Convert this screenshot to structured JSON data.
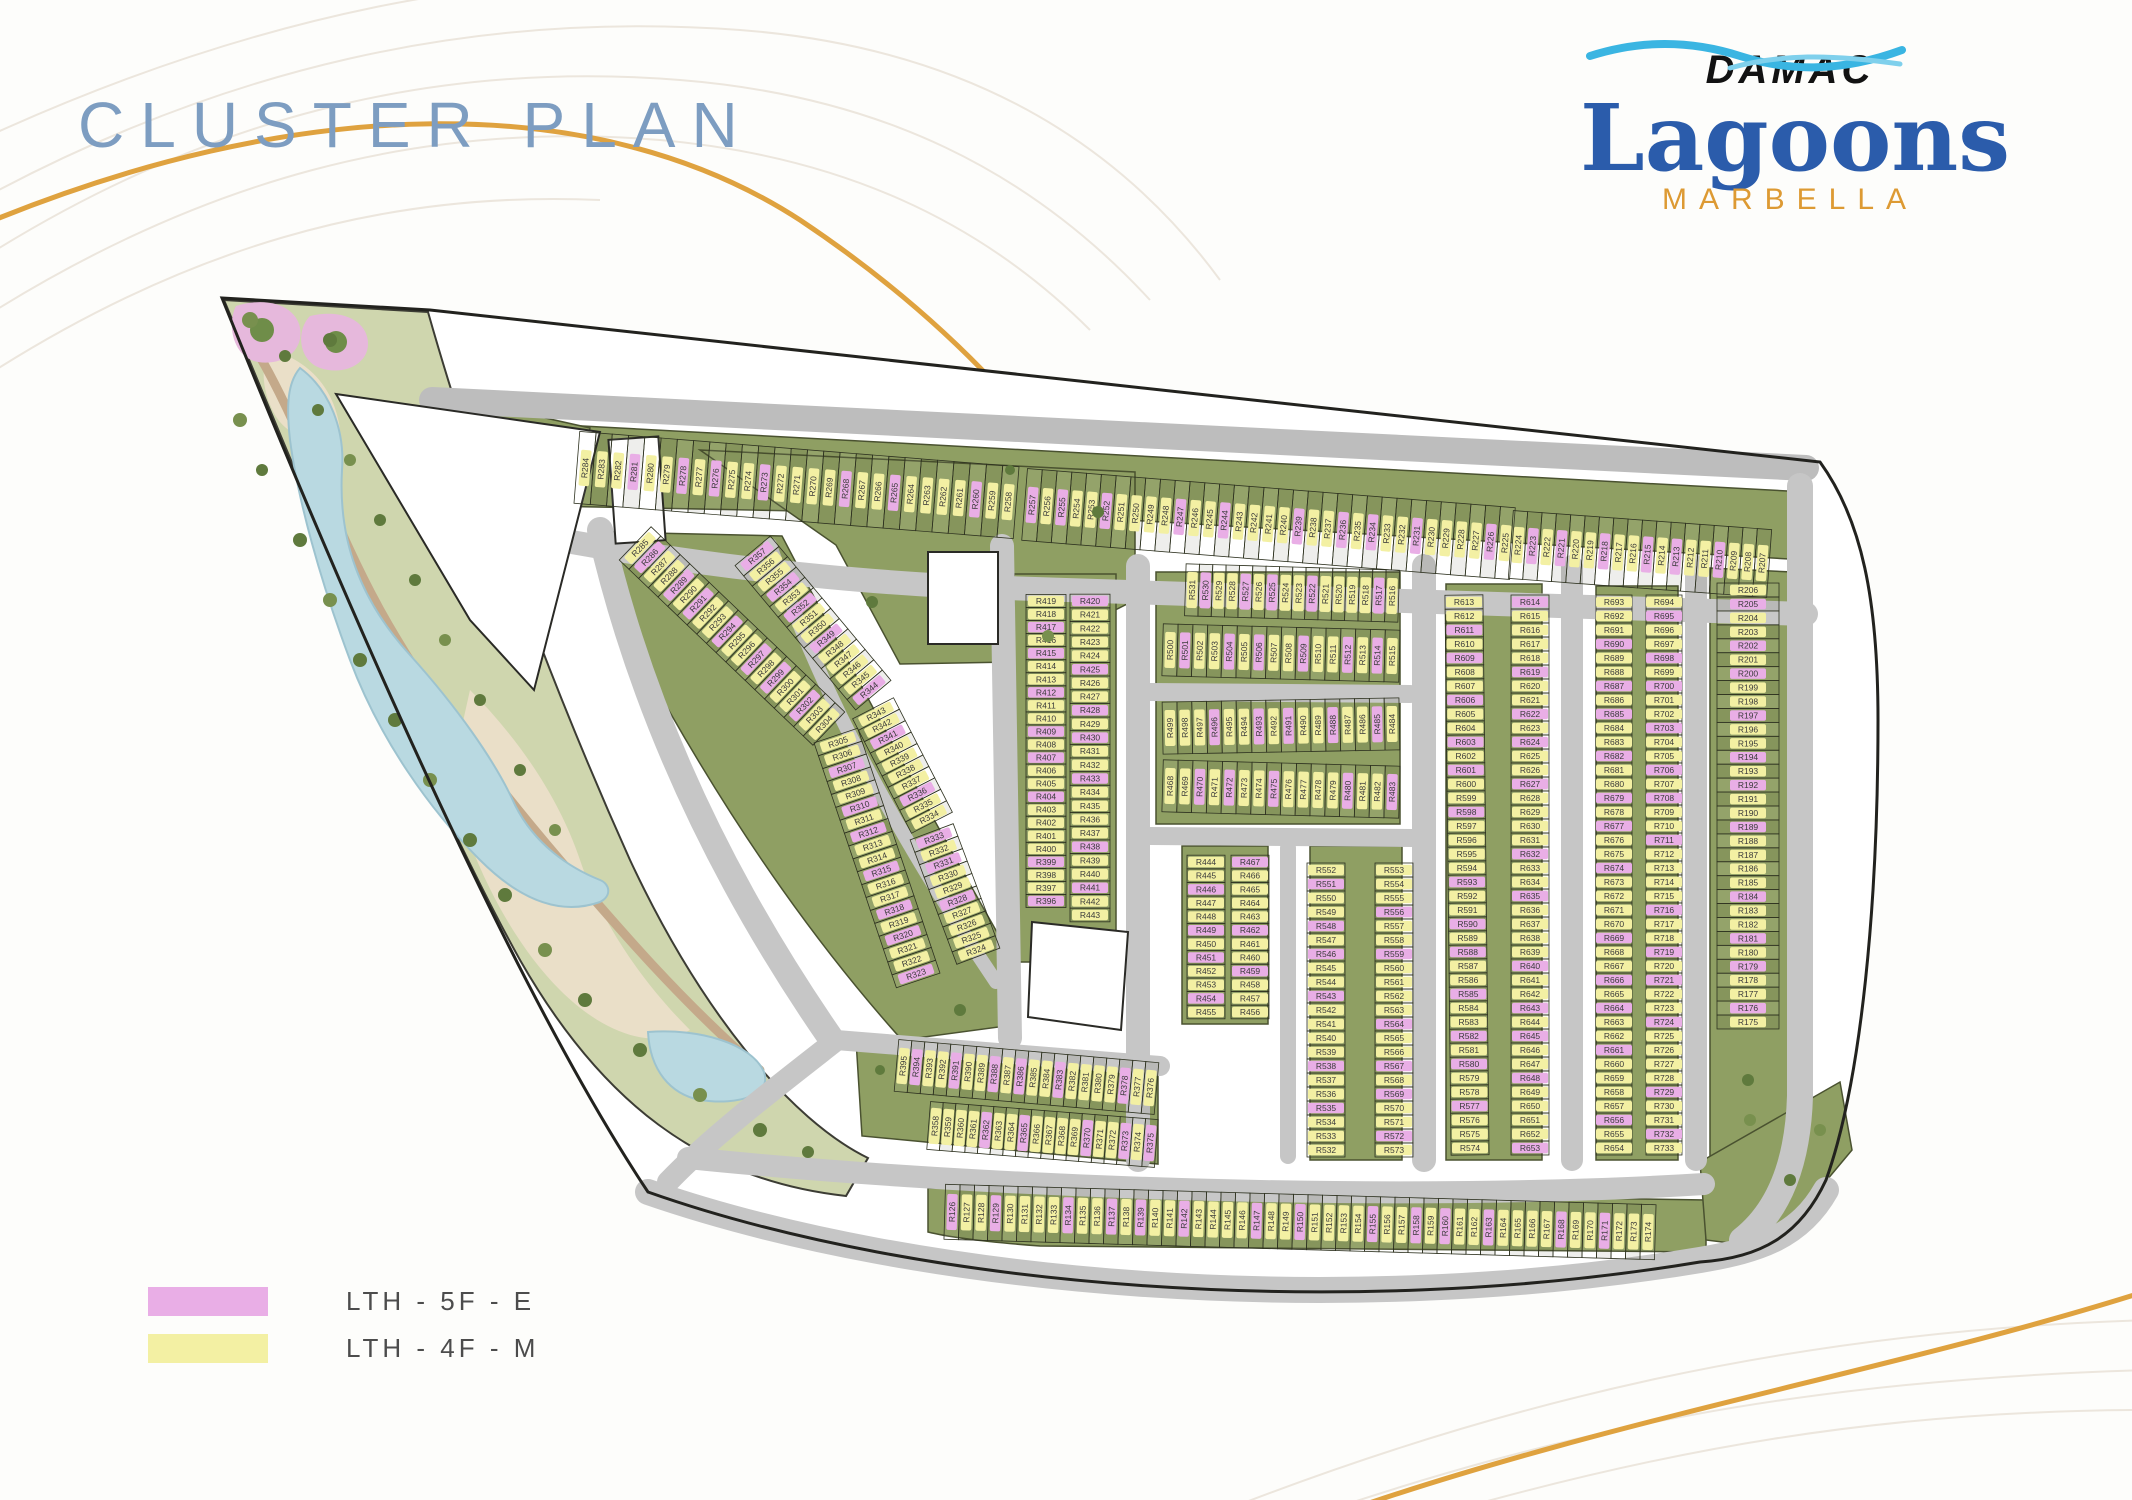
{
  "page": {
    "title": "CLUSTER PLAN"
  },
  "logo": {
    "brand": "DAMAC",
    "name": "Lagoons",
    "community": "MARBELLA"
  },
  "legend": {
    "items": [
      {
        "label": "LTH - 5F - E",
        "color": "#e9aee6"
      },
      {
        "label": "LTH - 4F - M",
        "color": "#f3f0a3"
      }
    ]
  },
  "colors": {
    "green": "#8f9f63",
    "greenEdge": "#4a5230",
    "road": "#c6c6c6",
    "roadDark": "#bdbdbd",
    "outline": "#22221e",
    "cellLine": "#2e3220",
    "pink": "#e9aee6",
    "yellow": "#f3f0a3",
    "labelText": "#3a3a3a",
    "water": "#b9d9e1",
    "sand": "#eadfc8",
    "path": "#c4a98a",
    "stripBase": "#cfd6ae",
    "flower": "#e6b8dc",
    "titleBlue": "#7d9dc1",
    "accentOrange": "#dfa23f"
  },
  "plan": {
    "unit_prefix": "R",
    "unit_number_min": 126,
    "unit_number_max": 733,
    "rows": [
      {
        "name": "top-row-west",
        "f": 284,
        "t": 258,
        "x1": 585,
        "y1": 468,
        "x2": 1008,
        "y2": 502,
        "d": 72,
        "flat": false
      },
      {
        "name": "top-row-center",
        "f": 257,
        "t": 225,
        "x1": 1032,
        "y1": 505,
        "x2": 1505,
        "y2": 543,
        "d": 72,
        "flat": false
      },
      {
        "name": "top-row-east",
        "f": 224,
        "t": 207,
        "x1": 1518,
        "y1": 545,
        "x2": 1762,
        "y2": 563,
        "d": 68,
        "flat": false
      },
      {
        "name": "right-edge-column",
        "f": 206,
        "t": 175,
        "x1": 1748,
        "y1": 590,
        "x2": 1748,
        "y2": 1022,
        "d": 62,
        "flat": true
      },
      {
        "name": "bottom-row",
        "f": 126,
        "t": 174,
        "x1": 952,
        "y1": 1212,
        "x2": 1648,
        "y2": 1232,
        "d": 55,
        "flat": false
      },
      {
        "name": "southwest-row-a",
        "f": 395,
        "t": 376,
        "x1": 903,
        "y1": 1066,
        "x2": 1150,
        "y2": 1088,
        "d": 52,
        "flat": false
      },
      {
        "name": "southwest-row-b",
        "f": 358,
        "t": 375,
        "x1": 935,
        "y1": 1126,
        "x2": 1150,
        "y2": 1143,
        "d": 48,
        "flat": false
      },
      {
        "name": "arc-outer-upper",
        "f": 285,
        "t": 304,
        "x1": 640,
        "y1": 548,
        "x2": 824,
        "y2": 724,
        "d": 46,
        "flat": false
      },
      {
        "name": "arc-outer-lower",
        "f": 305,
        "t": 323,
        "x1": 838,
        "y1": 742,
        "x2": 916,
        "y2": 974,
        "d": 46,
        "flat": false
      },
      {
        "name": "arc-inner-upper",
        "f": 357,
        "t": 344,
        "x1": 757,
        "y1": 556,
        "x2": 869,
        "y2": 690,
        "d": 46,
        "flat": false
      },
      {
        "name": "arc-inner-middle",
        "f": 343,
        "t": 334,
        "x1": 876,
        "y1": 714,
        "x2": 929,
        "y2": 817,
        "d": 46,
        "flat": false
      },
      {
        "name": "arc-inner-lower",
        "f": 333,
        "t": 324,
        "x1": 934,
        "y1": 838,
        "x2": 976,
        "y2": 950,
        "d": 46,
        "flat": false
      },
      {
        "name": "col-west-left",
        "f": 419,
        "t": 396,
        "x1": 1046,
        "y1": 601,
        "x2": 1046,
        "y2": 901,
        "d": 40,
        "flat": true
      },
      {
        "name": "col-west-right",
        "f": 420,
        "t": 443,
        "x1": 1090,
        "y1": 601,
        "x2": 1090,
        "y2": 915,
        "d": 40,
        "flat": true
      },
      {
        "name": "strip-a1",
        "f": 531,
        "t": 516,
        "x1": 1192,
        "y1": 590,
        "x2": 1392,
        "y2": 596,
        "d": 52,
        "flat": false
      },
      {
        "name": "strip-a2",
        "f": 500,
        "t": 515,
        "x1": 1170,
        "y1": 650,
        "x2": 1392,
        "y2": 656,
        "d": 52,
        "flat": false
      },
      {
        "name": "strip-b1",
        "f": 499,
        "t": 484,
        "x1": 1170,
        "y1": 728,
        "x2": 1392,
        "y2": 724,
        "d": 52,
        "flat": false
      },
      {
        "name": "strip-b2",
        "f": 468,
        "t": 483,
        "x1": 1170,
        "y1": 786,
        "x2": 1392,
        "y2": 792,
        "d": 52,
        "flat": false
      },
      {
        "name": "col-c-left",
        "f": 444,
        "t": 455,
        "x1": 1206,
        "y1": 862,
        "x2": 1206,
        "y2": 1012,
        "d": 38,
        "flat": true
      },
      {
        "name": "col-c-right",
        "f": 467,
        "t": 456,
        "x1": 1250,
        "y1": 862,
        "x2": 1250,
        "y2": 1012,
        "d": 38,
        "flat": true
      },
      {
        "name": "col-d-left",
        "f": 552,
        "t": 532,
        "x1": 1326,
        "y1": 870,
        "x2": 1326,
        "y2": 1150,
        "d": 38,
        "flat": true
      },
      {
        "name": "col-d-right",
        "f": 553,
        "t": 573,
        "x1": 1394,
        "y1": 870,
        "x2": 1394,
        "y2": 1150,
        "d": 38,
        "flat": true
      },
      {
        "name": "col-e-left",
        "f": 613,
        "t": 574,
        "x1": 1464,
        "y1": 602,
        "x2": 1470,
        "y2": 1148,
        "d": 38,
        "flat": true
      },
      {
        "name": "col-e-right",
        "f": 614,
        "t": 653,
        "x1": 1530,
        "y1": 602,
        "x2": 1530,
        "y2": 1148,
        "d": 38,
        "flat": true
      },
      {
        "name": "col-f-left",
        "f": 693,
        "t": 654,
        "x1": 1614,
        "y1": 602,
        "x2": 1614,
        "y2": 1148,
        "d": 36,
        "flat": true
      },
      {
        "name": "col-f-right",
        "f": 694,
        "t": 733,
        "x1": 1664,
        "y1": 602,
        "x2": 1664,
        "y2": 1148,
        "d": 36,
        "flat": true
      }
    ]
  }
}
